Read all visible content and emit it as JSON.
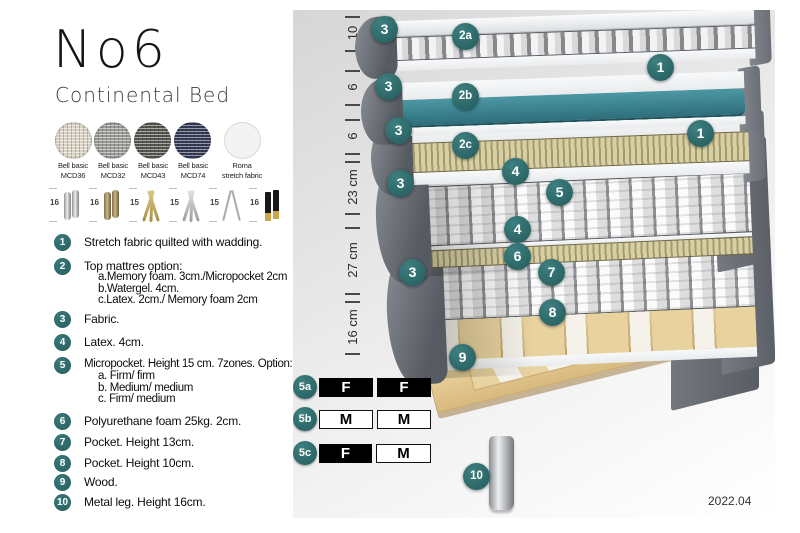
{
  "title": "No6",
  "subtitle": "Continental Bed",
  "swatches": [
    {
      "line1": "Bell basic",
      "line2": "MCD36",
      "color": "#d9d4c5"
    },
    {
      "line1": "Bell basic",
      "line2": "MCD32",
      "color": "#9b9b97"
    },
    {
      "line1": "Bell basic",
      "line2": "MCD43",
      "color": "#565650"
    },
    {
      "line1": "Bell basic",
      "line2": "MCD74",
      "color": "#343a58"
    },
    {
      "line1": "Roma",
      "line2": "stretch fabric",
      "color": "#f3f3f3"
    }
  ],
  "legs": [
    {
      "height": "16",
      "type": "chrome cylinder legs"
    },
    {
      "height": "16",
      "type": "bronze cylinder legs"
    },
    {
      "height": "15",
      "type": "gold twisted legs"
    },
    {
      "height": "15",
      "type": "silver twisted legs"
    },
    {
      "height": "15",
      "type": "hairpin legs"
    },
    {
      "height": "16",
      "type": "black legs with gold feet"
    }
  ],
  "list": [
    {
      "num": "1",
      "text": "Stretch fabric quilted with wadding."
    },
    {
      "num": "2",
      "text": "Top mattres option:",
      "sub": [
        "a.Memory foam. 3cm./Micropocket 2cm",
        "b.Watergel. 4cm.",
        "c.Latex. 2cm./ Memory foam 2cm"
      ]
    },
    {
      "num": "3",
      "text": "Fabric."
    },
    {
      "num": "4",
      "text": "Latex. 4cm."
    },
    {
      "num": "5",
      "text": "Micropocket. Height 15 cm. 7zones. Option:",
      "sub": [
        "a. Firm/ firm",
        "b. Medium/ medium",
        "c. Firm/ medium"
      ]
    },
    {
      "num": "6",
      "text": "Polyurethane foam 25kg. 2cm."
    },
    {
      "num": "7",
      "text": "Pocket. Height 13cm."
    },
    {
      "num": "8",
      "text": "Pocket. Height 10cm."
    },
    {
      "num": "9",
      "text": "Wood."
    },
    {
      "num": "10",
      "text": "Metal leg. Height 16cm."
    }
  ],
  "diagram": {
    "measurements": [
      "10",
      "6",
      "6",
      "23 cm",
      "27 cm",
      "16 cm"
    ],
    "badges": [
      "3",
      "2a",
      "1",
      "3",
      "2b",
      "3",
      "1",
      "2c",
      "4",
      "3",
      "5",
      "4",
      "6",
      "3",
      "7",
      "8",
      "9",
      "10"
    ],
    "firmness": [
      {
        "id": "5a",
        "cells": [
          {
            "label": "F",
            "style": "dark"
          },
          {
            "label": "F",
            "style": "dark"
          }
        ]
      },
      {
        "id": "5b",
        "cells": [
          {
            "label": "M",
            "style": "light"
          },
          {
            "label": "M",
            "style": "light"
          }
        ]
      },
      {
        "id": "5c",
        "cells": [
          {
            "label": "F",
            "style": "dark"
          },
          {
            "label": "M",
            "style": "light"
          }
        ]
      }
    ],
    "version": "2022.04"
  },
  "colors": {
    "accent_teal": "#2d6c6e",
    "watergel": "#37808d",
    "wood": "#e8d2a0"
  }
}
